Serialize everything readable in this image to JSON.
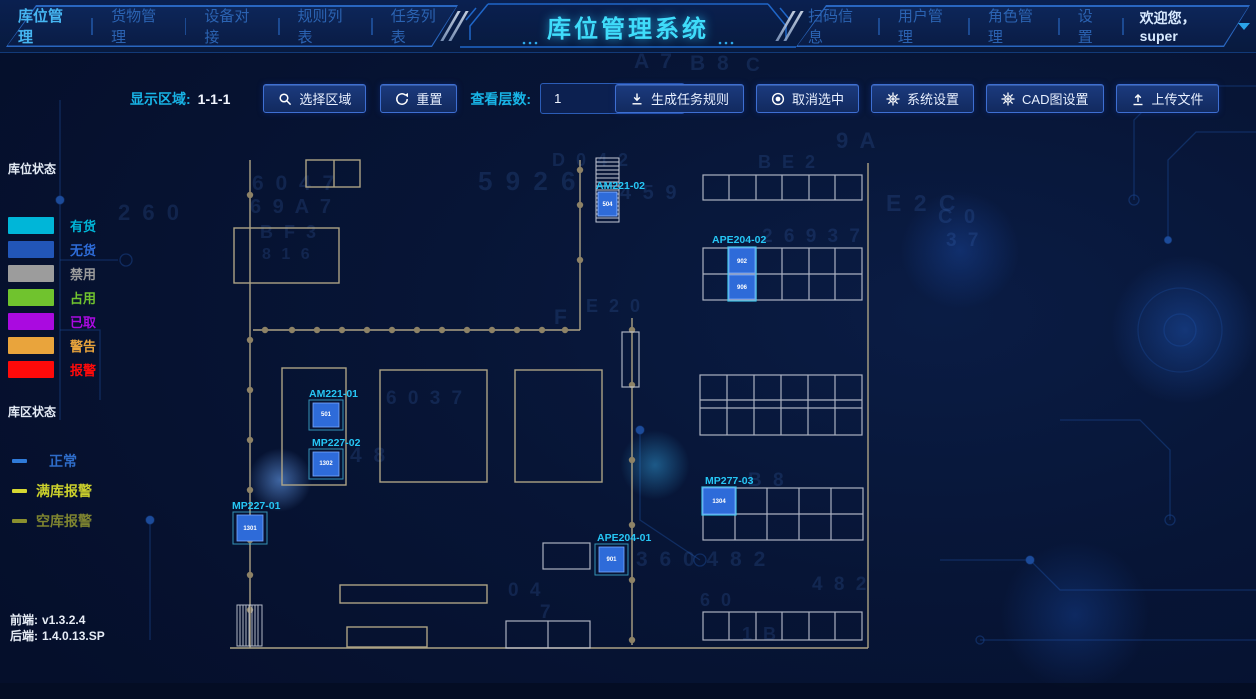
{
  "header": {
    "title": "库位管理系统",
    "nav_left": [
      {
        "label": "库位管理",
        "active": true
      },
      {
        "label": "货物管理",
        "active": false
      },
      {
        "label": "设备对接",
        "active": false
      },
      {
        "label": "规则列表",
        "active": false
      },
      {
        "label": "任务列表",
        "active": false
      }
    ],
    "nav_right": [
      {
        "label": "扫码信息"
      },
      {
        "label": "用户管理"
      },
      {
        "label": "角色管理"
      },
      {
        "label": "设置"
      }
    ],
    "welcome": "欢迎您，super"
  },
  "toolbar": {
    "display_area_label": "显示区域:",
    "display_area_value": "1-1-1",
    "select_area_btn": "选择区域",
    "reset_btn": "重置",
    "view_layer_label": "查看层数:",
    "view_layer_value": "1",
    "generate_rules_btn": "生成任务规则",
    "cancel_select_btn": "取消选中",
    "system_settings_btn": "系统设置",
    "cad_settings_btn": "CAD图设置",
    "upload_btn": "上传文件"
  },
  "legend": {
    "slot_title": "库位状态",
    "slot_items": [
      {
        "label": "有货",
        "color": "#00b6d8"
      },
      {
        "label": "无货",
        "color": "#2256b8",
        "text": "#2e6cd8"
      },
      {
        "label": "禁用",
        "color": "#9c9c9c"
      },
      {
        "label": "占用",
        "color": "#70c32e"
      },
      {
        "label": "已取",
        "color": "#aa0ae0"
      },
      {
        "label": "警告",
        "color": "#e9a43c"
      },
      {
        "label": "报警",
        "color": "#ff0a0a"
      }
    ],
    "zone_title": "库区状态",
    "zone_items": [
      {
        "label": "正常",
        "color": "#2f7bd9",
        "text": "#2e6cc8",
        "indent": 22
      },
      {
        "label": "满库报警",
        "color": "#d6d832",
        "text": "#cbd02c",
        "indent": 0
      },
      {
        "label": "空库报警",
        "color": "#8a8f2e",
        "text": "#7e8430",
        "indent": 0
      }
    ]
  },
  "versions": {
    "front_label": "前端:",
    "front": "v1.3.2.4",
    "back_label": "后端:",
    "back": "1.4.0.13.SP"
  },
  "plan": {
    "units": {
      "am221_02": {
        "label": "AM221-02",
        "cell": "504"
      },
      "ape204_02": {
        "label": "APE204-02",
        "cell_top": "902",
        "cell_bottom": "906"
      },
      "am221_01": {
        "label": "AM221-01",
        "cell": "501"
      },
      "mp227_02": {
        "label": "MP227-02",
        "cell": "1302"
      },
      "mp227_01": {
        "label": "MP227-01",
        "cell": "1301"
      },
      "ape204_01": {
        "label": "APE204-01",
        "cell": "901"
      },
      "mp277_03": {
        "label": "MP277-03",
        "cell": "1304"
      }
    }
  },
  "decor": {
    "hex_chars": [
      {
        "t": "A 7",
        "x": 634,
        "y": 50,
        "s": 21
      },
      {
        "t": "B 8",
        "x": 690,
        "y": 52,
        "s": 21
      },
      {
        "t": "C",
        "x": 746,
        "y": 55,
        "s": 19
      },
      {
        "t": "9 A",
        "x": 836,
        "y": 128,
        "s": 22
      },
      {
        "t": "2 6 0",
        "x": 118,
        "y": 200,
        "s": 22
      },
      {
        "t": "6 0 4 7",
        "x": 252,
        "y": 172,
        "s": 21
      },
      {
        "t": "5 9 2 6",
        "x": 478,
        "y": 166,
        "s": 26
      },
      {
        "t": "6 9 A 7",
        "x": 250,
        "y": 196,
        "s": 20
      },
      {
        "t": "D 0 4 2",
        "x": 552,
        "y": 150,
        "s": 18
      },
      {
        "t": "4 5 9",
        "x": 620,
        "y": 182,
        "s": 20
      },
      {
        "t": "B E 2",
        "x": 758,
        "y": 152,
        "s": 18
      },
      {
        "t": "E 2 C",
        "x": 886,
        "y": 190,
        "s": 23
      },
      {
        "t": "C 0",
        "x": 938,
        "y": 206,
        "s": 20
      },
      {
        "t": "3 7",
        "x": 946,
        "y": 230,
        "s": 19
      },
      {
        "t": "B F 3",
        "x": 260,
        "y": 222,
        "s": 18
      },
      {
        "t": "8 1 6",
        "x": 262,
        "y": 246,
        "s": 16
      },
      {
        "t": "2 6 9 3 7",
        "x": 762,
        "y": 226,
        "s": 19
      },
      {
        "t": "E 2 0",
        "x": 586,
        "y": 296,
        "s": 18
      },
      {
        "t": "F",
        "x": 554,
        "y": 306,
        "s": 21
      },
      {
        "t": "6 0 3 7",
        "x": 386,
        "y": 388,
        "s": 19
      },
      {
        "t": "4 8",
        "x": 350,
        "y": 444,
        "s": 21
      },
      {
        "t": "B 8",
        "x": 748,
        "y": 470,
        "s": 19
      },
      {
        "t": "3 6 0 4 8 2",
        "x": 636,
        "y": 548,
        "s": 21
      },
      {
        "t": "0 4",
        "x": 508,
        "y": 580,
        "s": 19
      },
      {
        "t": "7",
        "x": 540,
        "y": 602,
        "s": 19
      },
      {
        "t": "6 0",
        "x": 700,
        "y": 590,
        "s": 18
      },
      {
        "t": "4 8 2",
        "x": 812,
        "y": 574,
        "s": 19
      },
      {
        "t": "1 B",
        "x": 742,
        "y": 624,
        "s": 18
      }
    ]
  }
}
